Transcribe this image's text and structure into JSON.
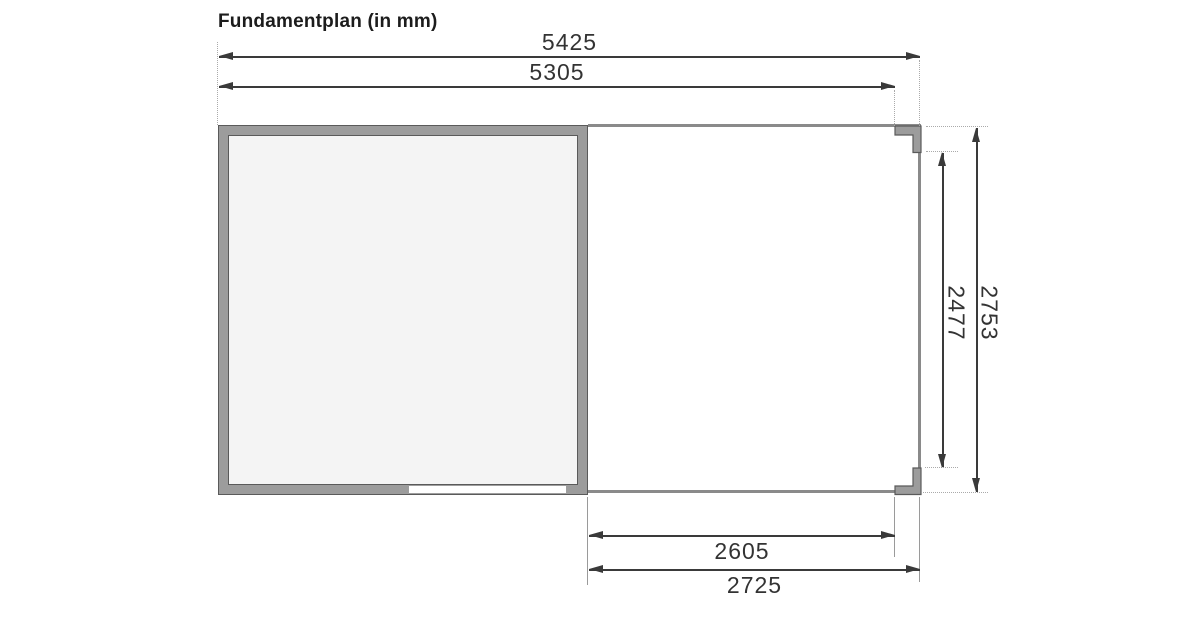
{
  "title": "Fundamentplan (in mm)",
  "unit": "mm",
  "drawing": {
    "type": "foundation-plan",
    "overall_width_mm": 5425,
    "foundation_width_mm": 5305,
    "annex_clear_width_mm": 2605,
    "annex_overall_width_mm": 2725,
    "annex_clear_depth_mm": 2477,
    "overall_depth_mm": 2753
  },
  "dims": {
    "top_outer": "5425",
    "top_inner": "5305",
    "bottom_inner": "2605",
    "bottom_outer": "2725",
    "right_inner": "2477",
    "right_outer": "2753"
  },
  "colors": {
    "background": "#ffffff",
    "wall_fill": "#9c9c9c",
    "wall_edge": "#5a5a5a",
    "room_interior": "#f4f4f4",
    "outline_gray": "#8a8a8a",
    "dim_line": "#3a3a3a",
    "extension_line": "#aaaaaa",
    "text": "#333333",
    "title_text": "#1c1c1c"
  }
}
